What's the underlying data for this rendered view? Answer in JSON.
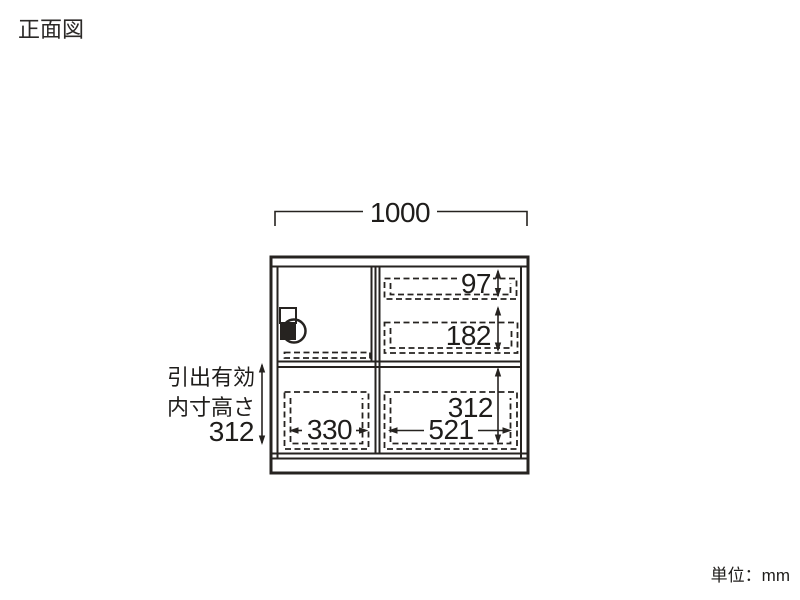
{
  "page": {
    "title": "正面図",
    "unit_label": "単位：mm"
  },
  "diagram": {
    "type": "furniture-front-view-dimension-drawing",
    "overall_width": "1000",
    "left_label": {
      "line1": "引出有効",
      "line2": "内寸高さ",
      "value": "312"
    },
    "dimensions": {
      "top_right_drawer_height": "97",
      "right_drawer_height": "182",
      "bottom_drawer_inner_height": "312",
      "bottom_left_drawer_width": "330",
      "bottom_right_drawer_width": "521"
    },
    "colors": {
      "line": "#262320",
      "text": "#1f1d1b",
      "background": "#ffffff"
    }
  }
}
